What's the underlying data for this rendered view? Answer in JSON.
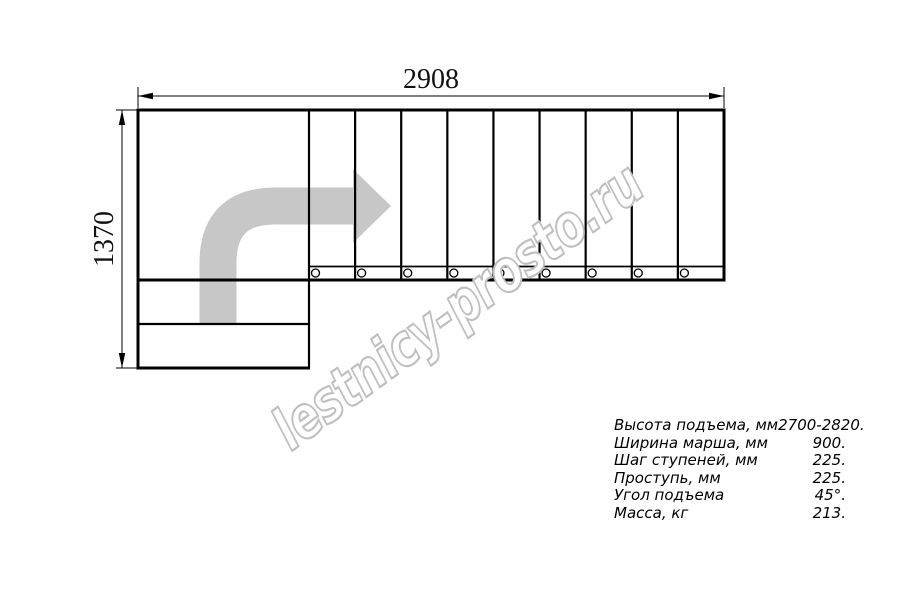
{
  "drawing": {
    "title": "L-shaped staircase plan view",
    "dimensions": {
      "width_label": "2908",
      "height_label": "1370"
    },
    "stair": {
      "tread_lines": 9,
      "balusters": 9,
      "lower_steps": 2
    },
    "arrow_color": "#c7c7c7",
    "line_color": "#000000"
  },
  "watermark": {
    "text": "lestnicy-prosto.ru",
    "stroke_color": "#bfbfbf"
  },
  "spec_table": {
    "rows": [
      {
        "label": "Высота подъема, мм",
        "value": "2700-2820."
      },
      {
        "label": "Ширина марша, мм",
        "value": "900."
      },
      {
        "label": "Шаг ступеней, мм",
        "value": "225."
      },
      {
        "label": "Проступь, мм",
        "value": "225."
      },
      {
        "label": "Угол подъема",
        "value": "45°."
      },
      {
        "label": "Масса, кг",
        "value": "213."
      }
    ]
  }
}
